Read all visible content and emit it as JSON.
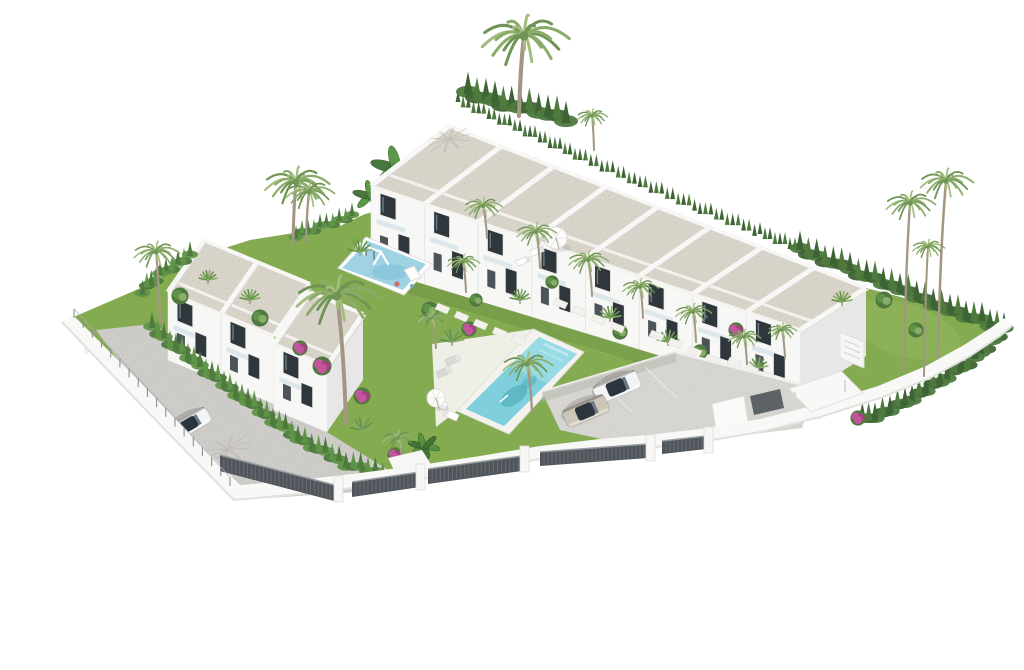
{
  "meta": {
    "description": "Aerial 3D architectural rendering of a white townhouse residential complex with gardens, a turquoise swimming pool, a blue playground, palm trees, a parking area with cars, and a curved white perimeter wall with dark slat fences, on a white background",
    "canvas": {
      "w": 1024,
      "h": 670
    }
  },
  "palette": {
    "bg": "#ffffff",
    "roof": "#d9d4ca",
    "roofDot": "#c3beb2",
    "white": "#f8f8f6",
    "whiteShade": "#ededeb",
    "facade": "#f7f7f5",
    "facadeShade": "#e8e9e7",
    "glass": "#2f373d",
    "glassLight": "#6d7d88",
    "frame": "#efefed",
    "grass": "#85ab51",
    "grassLight": "#97bc60",
    "grassShadow": "#6d9143",
    "road": "#ceccc8",
    "parking": "#d7d5d1",
    "wall": "#f8f8f6",
    "wallEdge": "#e1e1df",
    "fence": "#4f555a",
    "fenceSlat": "#6d7377",
    "fenceRail": "#979ca0",
    "hedge1": "#3e6434",
    "hedge2": "#4e7a3e",
    "hedge3": "#5f9347",
    "palmGreen1": "#6f9455",
    "palmGreen2": "#8aac68",
    "palmGreen3": "#a4bd7e",
    "trunk": "#a39684",
    "pool": "#7fd0dc",
    "poolLight": "#ace4ec",
    "poolDark": "#3f9fb0",
    "play": "#9fd3e4",
    "playDark": "#7fc2d8",
    "deck": "#f3f2ee",
    "pink": "#c2559b",
    "pinkDark": "#a83f85",
    "carWhite": "#f3f4f5",
    "carBeige": "#cdc6b8",
    "carMaroon": "#7c2741",
    "carGlass": "#2c353d",
    "shadow": "#b3b0a9"
  },
  "blocks": {
    "row": {
      "name": "townhouse-row",
      "ridge": [
        [
          449,
          126
        ],
        [
          866,
          288
        ]
      ],
      "eave": [
        [
          371,
          186
        ],
        [
          800,
          330
        ]
      ],
      "base": [
        [
          371,
          268
        ],
        [
          800,
          398
        ]
      ],
      "units": 8,
      "gableLeft": true,
      "gableRight": true
    },
    "left": {
      "name": "left-townhouse-block",
      "ridge": [
        [
          204,
          240
        ],
        [
          310,
          284
        ]
      ],
      "eave": [
        [
          168,
          292
        ],
        [
          274,
          336
        ]
      ],
      "base": [
        [
          168,
          360
        ],
        [
          274,
          404
        ]
      ],
      "units": 2,
      "gableLeft": true,
      "gableRight": false
    },
    "leftLow": {
      "name": "left-block-low-wing",
      "ridge": [
        [
          310,
          292
        ],
        [
          363,
          314
        ]
      ],
      "eave": [
        [
          274,
          344
        ],
        [
          327,
          366
        ]
      ],
      "base": [
        [
          274,
          410
        ],
        [
          327,
          432
        ]
      ],
      "units": 1,
      "gableLeft": false,
      "gableRight": true
    }
  },
  "objects": {
    "palms": [
      {
        "cx": 524,
        "cy": 36,
        "r": 46,
        "bx": 519,
        "by": 116,
        "layer": "bg"
      },
      {
        "cx": 296,
        "cy": 182,
        "r": 34,
        "bx": 293,
        "by": 242,
        "layer": "bg"
      },
      {
        "cx": 309,
        "cy": 192,
        "r": 26,
        "bx": 306,
        "by": 242,
        "layer": "bg"
      },
      {
        "cx": 592,
        "cy": 116,
        "r": 16,
        "bx": 594,
        "by": 150,
        "layer": "bg"
      },
      {
        "cx": 156,
        "cy": 252,
        "r": 24,
        "bx": 160,
        "by": 324,
        "layer": "main"
      },
      {
        "cx": 337,
        "cy": 296,
        "r": 44,
        "bx": 346,
        "by": 424,
        "layer": "main"
      },
      {
        "cx": 483,
        "cy": 206,
        "r": 20,
        "bx": 487,
        "by": 238,
        "layer": "main"
      },
      {
        "cx": 536,
        "cy": 232,
        "r": 21,
        "bx": 540,
        "by": 268,
        "layer": "main"
      },
      {
        "cx": 588,
        "cy": 260,
        "r": 21,
        "bx": 592,
        "by": 296,
        "layer": "main"
      },
      {
        "cx": 640,
        "cy": 287,
        "r": 19,
        "bx": 643,
        "by": 318,
        "layer": "main"
      },
      {
        "cx": 693,
        "cy": 312,
        "r": 19,
        "bx": 696,
        "by": 342,
        "layer": "main"
      },
      {
        "cx": 744,
        "cy": 337,
        "r": 17,
        "bx": 747,
        "by": 364,
        "layer": "main"
      },
      {
        "cx": 527,
        "cy": 364,
        "r": 26,
        "bx": 532,
        "by": 412,
        "layer": "main"
      },
      {
        "cx": 463,
        "cy": 262,
        "r": 17,
        "bx": 466,
        "by": 292,
        "layer": "main"
      },
      {
        "cx": 432,
        "cy": 318,
        "r": 15,
        "bx": 436,
        "by": 348,
        "layer": "main"
      },
      {
        "cx": 782,
        "cy": 330,
        "r": 15,
        "bx": 785,
        "by": 358,
        "layer": "main"
      },
      {
        "cx": 398,
        "cy": 438,
        "r": 17,
        "bx": 402,
        "by": 460,
        "layer": "main"
      },
      {
        "cx": 910,
        "cy": 203,
        "r": 26,
        "bx": 904,
        "by": 370,
        "layer": "right"
      },
      {
        "cx": 946,
        "cy": 181,
        "r": 28,
        "bx": 938,
        "by": 358,
        "layer": "right"
      },
      {
        "cx": 928,
        "cy": 247,
        "r": 17,
        "bx": 924,
        "by": 376,
        "layer": "right"
      }
    ],
    "fanPalms": [
      {
        "x": 360,
        "y": 252,
        "s": 12
      },
      {
        "x": 452,
        "y": 342,
        "s": 12
      },
      {
        "x": 610,
        "y": 318,
        "s": 11
      },
      {
        "x": 668,
        "y": 342,
        "s": 11
      },
      {
        "x": 520,
        "y": 300,
        "s": 10
      },
      {
        "x": 362,
        "y": 430,
        "s": 12
      },
      {
        "x": 842,
        "y": 302,
        "s": 10
      },
      {
        "x": 250,
        "y": 300,
        "s": 10
      },
      {
        "x": 208,
        "y": 280,
        "s": 9
      },
      {
        "x": 758,
        "y": 368,
        "s": 10
      }
    ],
    "bananas": [
      {
        "x": 398,
        "y": 168,
        "r": 34,
        "layer": "bg"
      },
      {
        "x": 372,
        "y": 196,
        "r": 24,
        "layer": "bg"
      },
      {
        "x": 424,
        "y": 446,
        "r": 20,
        "layer": "main"
      }
    ],
    "bushes": [
      {
        "x": 322,
        "y": 366,
        "r": 10,
        "c": "pink"
      },
      {
        "x": 362,
        "y": 396,
        "r": 9,
        "c": "pink"
      },
      {
        "x": 469,
        "y": 329,
        "r": 8,
        "c": "pink"
      },
      {
        "x": 736,
        "y": 330,
        "r": 8,
        "c": "pink"
      },
      {
        "x": 858,
        "y": 418,
        "r": 8,
        "c": "pink"
      },
      {
        "x": 395,
        "y": 455,
        "r": 8,
        "c": "pink"
      },
      {
        "x": 300,
        "y": 348,
        "r": 8,
        "c": "pink"
      },
      {
        "x": 430,
        "y": 310,
        "r": 9,
        "c": "green"
      },
      {
        "x": 476,
        "y": 300,
        "r": 7,
        "c": "green"
      },
      {
        "x": 620,
        "y": 332,
        "r": 8,
        "c": "green"
      },
      {
        "x": 552,
        "y": 282,
        "r": 7,
        "c": "green"
      },
      {
        "x": 700,
        "y": 352,
        "r": 8,
        "c": "green"
      },
      {
        "x": 260,
        "y": 318,
        "r": 9,
        "c": "green"
      },
      {
        "x": 180,
        "y": 296,
        "r": 9,
        "c": "green"
      },
      {
        "x": 884,
        "y": 300,
        "r": 9,
        "c": "green"
      },
      {
        "x": 916,
        "y": 330,
        "r": 8,
        "c": "green"
      }
    ],
    "hedges": [
      {
        "pts": [
          [
            458,
            104
          ],
          [
            520,
            132
          ],
          [
            580,
            160
          ],
          [
            640,
            186
          ],
          [
            700,
            212
          ],
          [
            760,
            236
          ],
          [
            800,
            252
          ]
        ],
        "s": 8,
        "dense": false,
        "c": [
          "hedge1",
          "hedge2"
        ],
        "layer": "bg"
      },
      {
        "pts": [
          [
            800,
            252
          ],
          [
            850,
            272
          ],
          [
            900,
            292
          ],
          [
            950,
            312
          ],
          [
            990,
            326
          ],
          [
            1004,
            332
          ]
        ],
        "s": 13,
        "dense": true,
        "c": [
          "hedge1",
          "hedge2"
        ],
        "layer": "bg"
      },
      {
        "pts": [
          [
            1004,
            332
          ],
          [
            975,
            360
          ],
          [
            940,
            384
          ],
          [
            905,
            404
          ],
          [
            875,
            418
          ],
          [
            856,
            424
          ]
        ],
        "s": 12,
        "dense": true,
        "c": [
          "hedge1",
          "hedge2"
        ],
        "layer": "bg"
      },
      {
        "pts": [
          [
            468,
            96
          ],
          [
            495,
            104
          ],
          [
            520,
            110
          ],
          [
            548,
            116
          ],
          [
            575,
            124
          ]
        ],
        "s": 15,
        "dense": true,
        "c": [
          "hedge1",
          "hedge2"
        ],
        "layer": "bg"
      },
      {
        "pts": [
          [
            152,
            330
          ],
          [
            200,
            368
          ],
          [
            248,
            404
          ],
          [
            298,
            440
          ],
          [
            346,
            466
          ],
          [
            390,
            478
          ]
        ],
        "s": 11,
        "dense": true,
        "c": [
          "hedge2",
          "hedge3"
        ],
        "layer": "garden"
      },
      {
        "pts": [
          [
            190,
            258
          ],
          [
            160,
            276
          ],
          [
            138,
            298
          ]
        ],
        "s": 10,
        "dense": true,
        "c": [
          "hedge2",
          "hedge3"
        ],
        "layer": "garden"
      },
      {
        "pts": [
          [
            352,
            218
          ],
          [
            320,
            228
          ],
          [
            290,
            240
          ]
        ],
        "s": 9,
        "dense": true,
        "c": [
          "hedge2",
          "hedge3"
        ],
        "layer": "bg"
      }
    ],
    "fences": [
      {
        "x1": 220,
        "y1": 455,
        "x2": 338,
        "y2": 486,
        "h": 16
      },
      {
        "x1": 352,
        "y1": 482,
        "x2": 420,
        "y2": 472,
        "h": 15
      },
      {
        "x1": 428,
        "y1": 469,
        "x2": 522,
        "y2": 456,
        "h": 15
      },
      {
        "x1": 540,
        "y1": 452,
        "x2": 648,
        "y2": 444,
        "h": 14
      },
      {
        "x1": 662,
        "y1": 441,
        "x2": 706,
        "y2": 436,
        "h": 13
      }
    ],
    "pillars": [
      {
        "x": 338,
        "y": 482
      },
      {
        "x": 420,
        "y": 470
      },
      {
        "x": 524,
        "y": 452
      },
      {
        "x": 650,
        "y": 441
      },
      {
        "x": 708,
        "y": 433
      }
    ],
    "posts": {
      "x1": 74,
      "y1": 318,
      "x2": 230,
      "y2": 486,
      "step": 13,
      "h": 9
    },
    "stones": [
      {
        "x": 438,
        "y": 303,
        "dx": 19,
        "dy": 8,
        "n": 5
      },
      {
        "x": 556,
        "y": 298,
        "dx": 19,
        "dy": 8,
        "n": 4
      },
      {
        "x": 652,
        "y": 330,
        "dx": 19,
        "dy": 8,
        "n": 4
      },
      {
        "x": 730,
        "y": 357,
        "dx": 17,
        "dy": 7,
        "n": 3
      }
    ],
    "cars": [
      {
        "x": 617,
        "y": 387,
        "a": 157,
        "l": 47,
        "w": 19,
        "c": "carWhite",
        "name": "white-sedan"
      },
      {
        "x": 586,
        "y": 411,
        "a": 157,
        "l": 46,
        "w": 19,
        "c": "carBeige",
        "name": "beige-sedan"
      },
      {
        "x": 190,
        "y": 424,
        "a": 150,
        "l": 43,
        "w": 17,
        "c": "carWhite",
        "name": "white-hatchback"
      },
      {
        "x": 831,
        "y": 404,
        "a": 155,
        "l": 40,
        "w": 16,
        "c": "carMaroon",
        "name": "maroon-car"
      }
    ],
    "loungers": [
      {
        "x": 537,
        "y": 251,
        "a": 157,
        "w": 14,
        "h": 6,
        "c": "#ffffff"
      },
      {
        "x": 523,
        "y": 261,
        "a": 157,
        "w": 14,
        "h": 6,
        "c": "#ffffff"
      },
      {
        "x": 453,
        "y": 360,
        "a": 157,
        "w": 15,
        "h": 7,
        "c": "#d8d8d4"
      },
      {
        "x": 444,
        "y": 372,
        "a": 157,
        "w": 15,
        "h": 7,
        "c": "#d8d8d4"
      },
      {
        "x": 440,
        "y": 404,
        "a": 24,
        "w": 15,
        "h": 7,
        "c": "#ffffff"
      },
      {
        "x": 451,
        "y": 415,
        "a": 24,
        "w": 15,
        "h": 7,
        "c": "#ffffff"
      }
    ],
    "parasols": [
      {
        "x": 556,
        "y": 238,
        "r": 11
      },
      {
        "x": 436,
        "y": 398,
        "r": 9
      }
    ],
    "palmShadows": [
      {
        "x": 449,
        "y": 140,
        "r": 26,
        "rot": -15
      },
      {
        "x": 228,
        "y": 450,
        "r": 30,
        "rot": -20
      },
      {
        "x": 94,
        "y": 346,
        "r": 13,
        "rot": -25
      }
    ]
  }
}
